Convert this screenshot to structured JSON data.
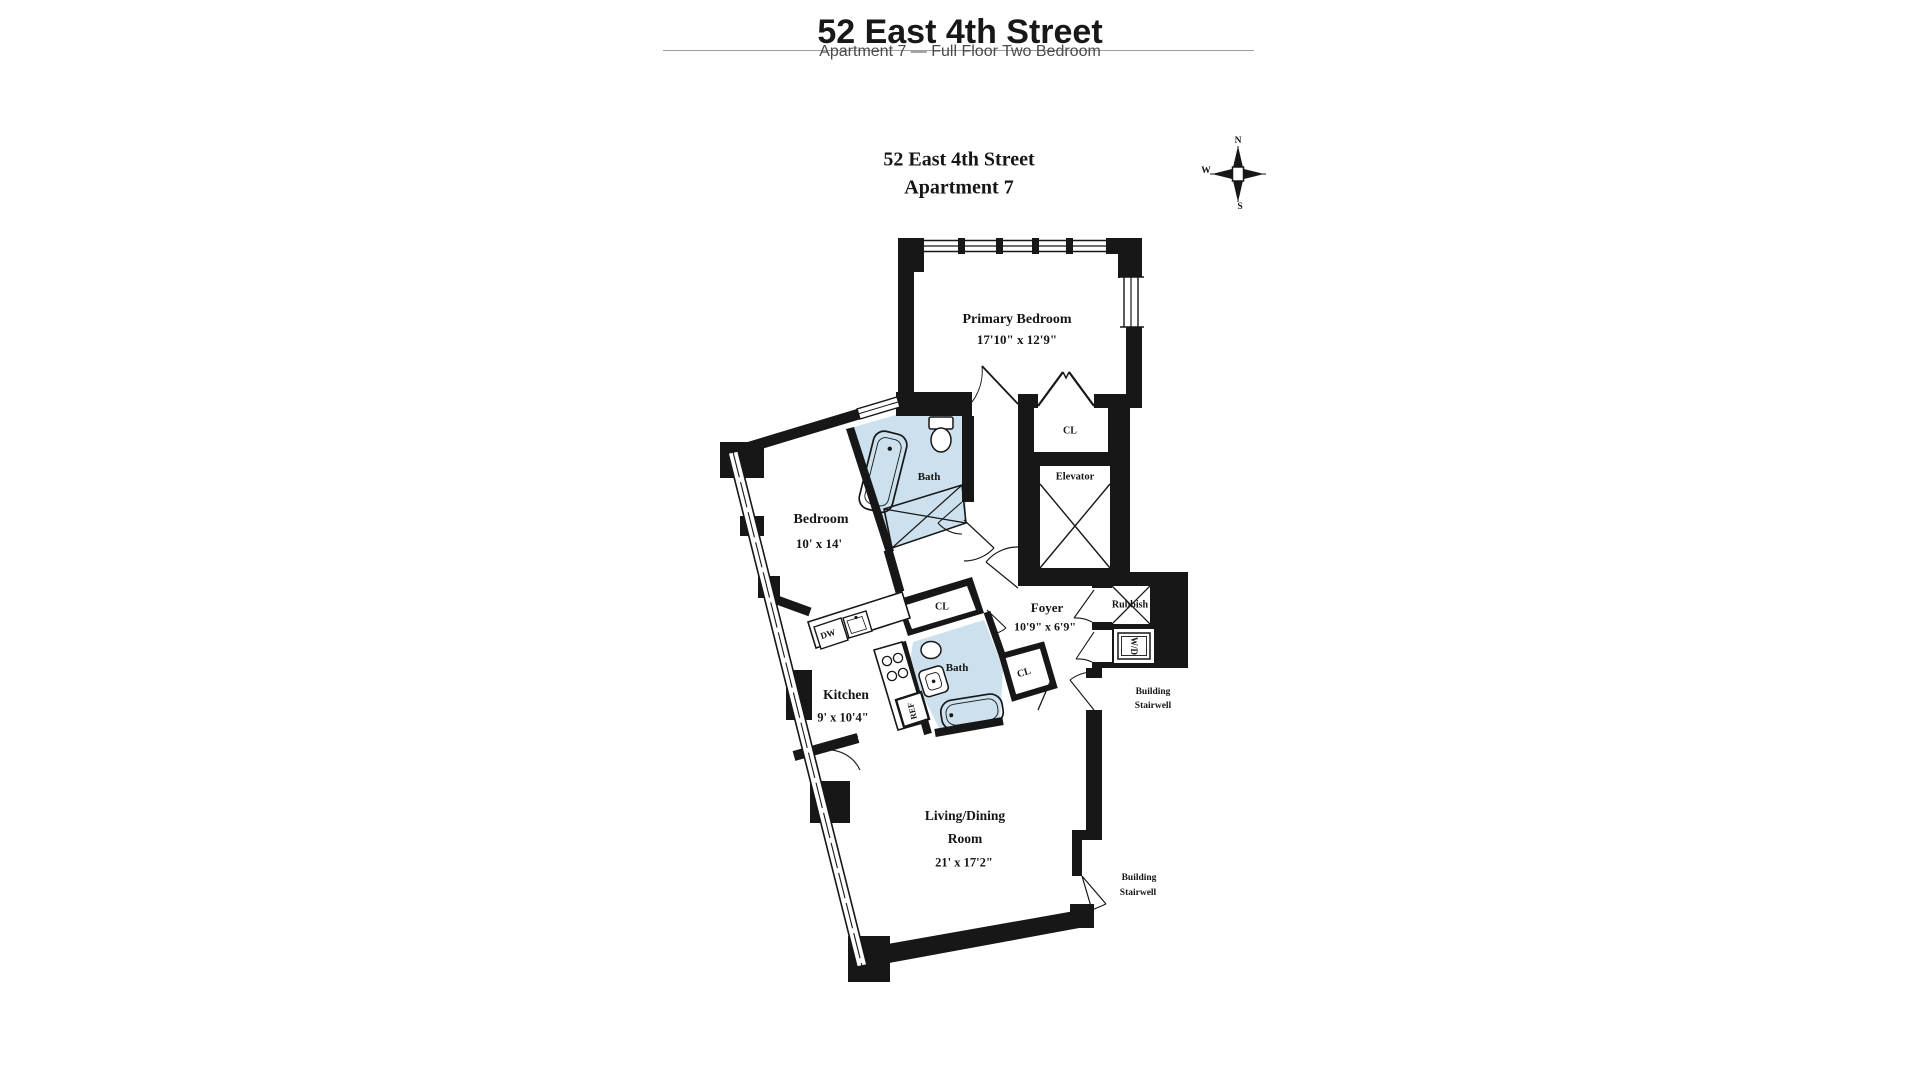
{
  "header": {
    "title": "52 East 4th Street",
    "subtitle": "Apartment 7 — Full Floor Two Bedroom"
  },
  "plan": {
    "title_line1": "52 East 4th Street",
    "title_line2": "Apartment 7",
    "compass": {
      "n": "N",
      "w": "W",
      "s": "S"
    },
    "rooms": {
      "primary_bedroom": {
        "name": "Primary Bedroom",
        "dims": "17'10\" x 12'9\""
      },
      "bedroom": {
        "name": "Bedroom",
        "dims": "10' x 14'"
      },
      "kitchen": {
        "name": "Kitchen",
        "dims": "9' x 10'4\""
      },
      "living_dining": {
        "name_line1": "Living/Dining",
        "name_line2": "Room",
        "dims": "21' x 17'2\""
      },
      "foyer": {
        "name": "Foyer",
        "dims": "10'9\" x 6'9\""
      },
      "bath_upper": {
        "name": "Bath"
      },
      "bath_lower": {
        "name": "Bath"
      },
      "elevator": {
        "name": "Elevator"
      },
      "rubbish": {
        "name": "Rubbish"
      },
      "washer_dryer": {
        "name": "W/D"
      },
      "dishwasher": {
        "name": "DW"
      },
      "refrigerator": {
        "name": "REF"
      }
    },
    "closets": {
      "primary": "CL",
      "hall": "CL",
      "foyer": "CL"
    },
    "stairwell_upper": {
      "line1": "Building",
      "line2": "Stairwell"
    },
    "stairwell_lower": {
      "line1": "Building",
      "line2": "Stairwell"
    },
    "colors": {
      "wall": "#171717",
      "bath_fill": "#cce1ed"
    }
  }
}
